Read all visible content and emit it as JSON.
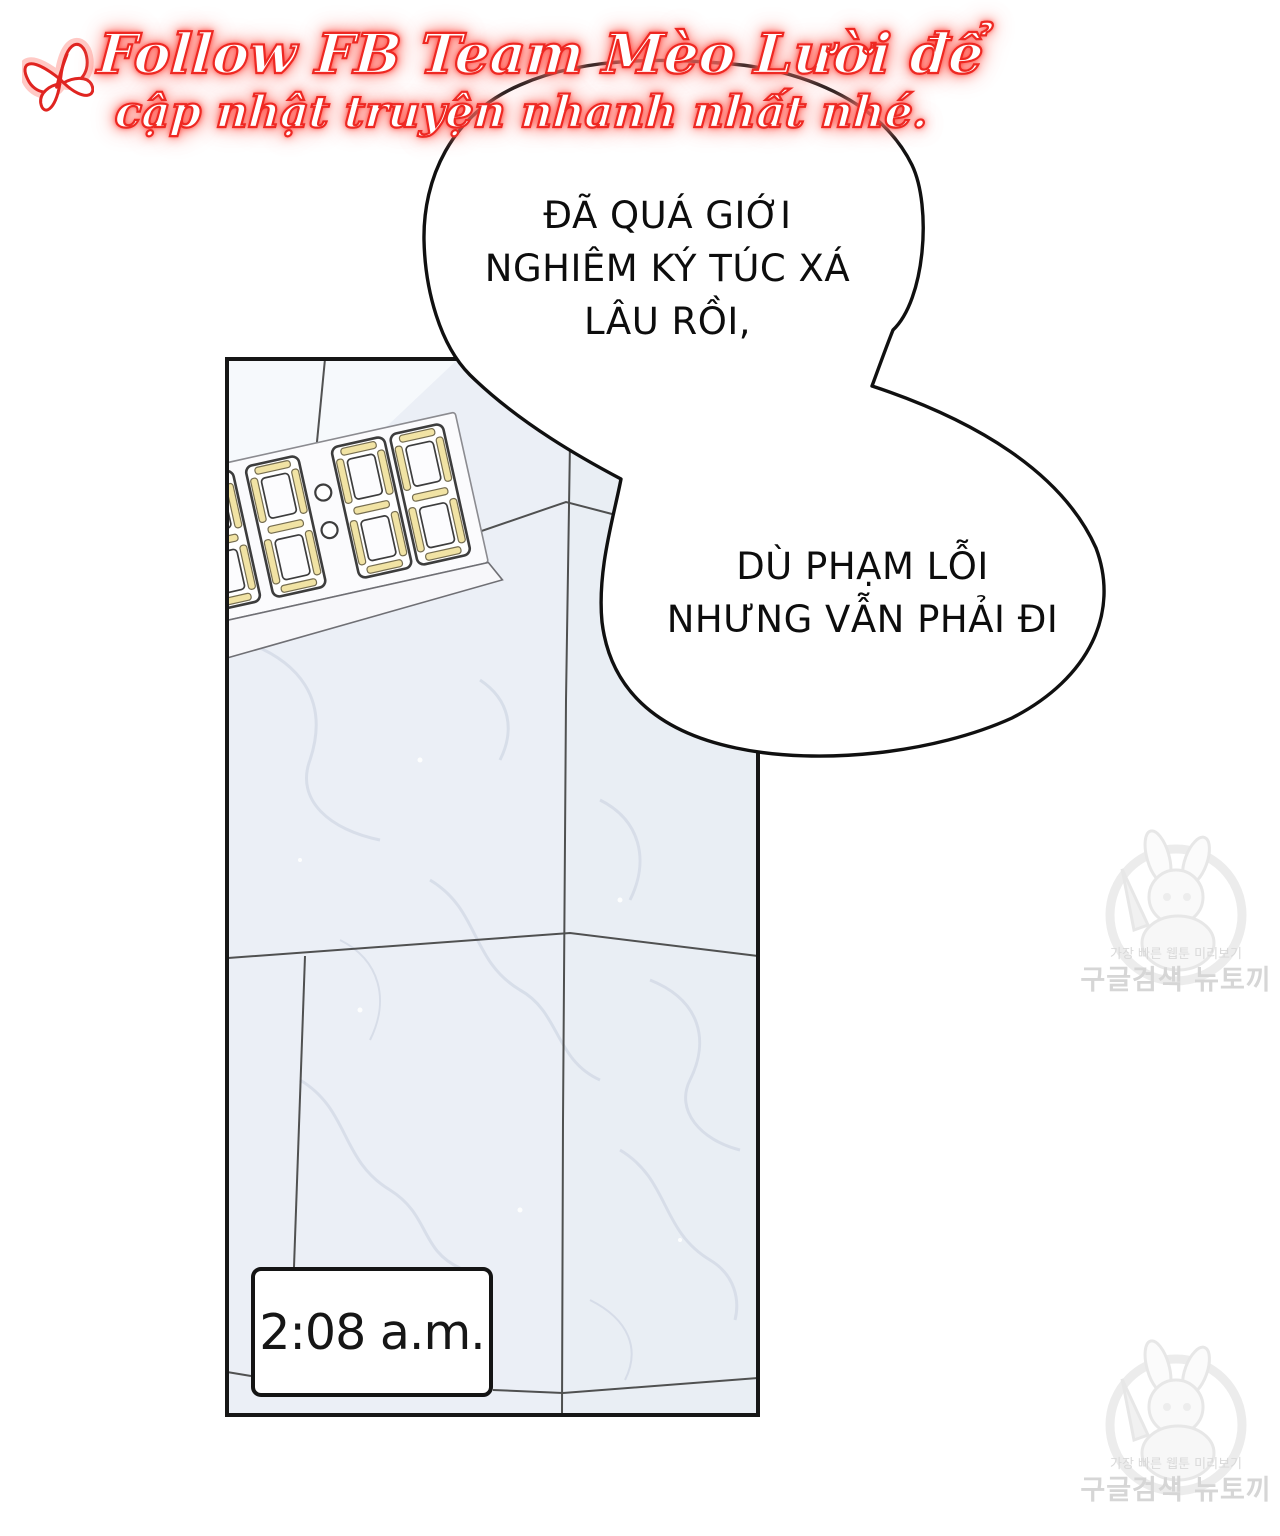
{
  "banner": {
    "icon": "butterfly-icon",
    "line1": "Follow FB Team Mèo Lười để",
    "line2": "cập nhật truyện nhanh nhất nhé.",
    "text_color": "#ffffff",
    "glow_color": "#ff2d26"
  },
  "bubble1": {
    "line1": "ĐÃ QUÁ GIỚI",
    "line2": "NGHIÊM KÝ TÚC XÁ",
    "line3": "LÂU RỒI,"
  },
  "bubble2": {
    "line1": "DÙ PHẠM LỖI",
    "line2": "NHƯNG VẪN PHẢI ĐI"
  },
  "panel": {
    "caption_time": "2:08 a.m.",
    "clock_display": "88:88",
    "clock_segment_color": "#f1e3a4",
    "wall_color": "#ebeff6"
  },
  "watermark": {
    "line_small": "가장 빠른 웹툰 미리보기",
    "line_big": "구글검색 뉴토끼"
  }
}
